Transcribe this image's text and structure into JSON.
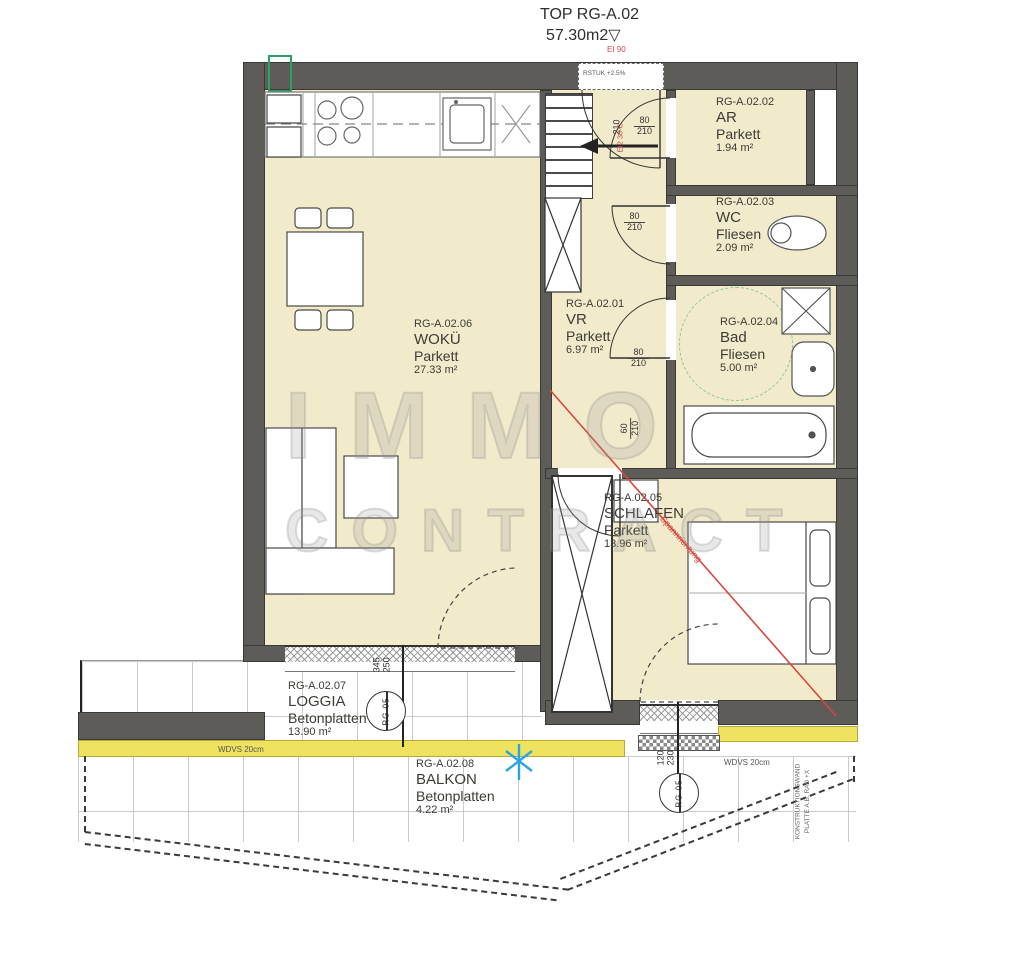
{
  "plan": {
    "title": "TOP RG-A.02",
    "area_total": "57.30m2",
    "level_symbol": "▽",
    "fire_note": "EI 90",
    "entrance_note": "RSTUK +2.5%",
    "entrance_fire_rating": "EI2 30-C",
    "span_note": "Spannrichtung",
    "watermark_line1": "IMMO",
    "watermark_line2": "CONTRACT"
  },
  "rooms": [
    {
      "id": "RG-A.02.01",
      "name": "VR",
      "floor": "Parkett",
      "area": "6.97 m²"
    },
    {
      "id": "RG-A.02.02",
      "name": "AR",
      "floor": "Parkett",
      "area": "1.94 m²"
    },
    {
      "id": "RG-A.02.03",
      "name": "WC",
      "floor": "Fliesen",
      "area": "2.09 m²"
    },
    {
      "id": "RG-A.02.04",
      "name": "Bad",
      "floor": "Fliesen",
      "area": "5.00 m²"
    },
    {
      "id": "RG-A.02.05",
      "name": "SCHLAFEN",
      "floor": "Parkett",
      "area": "13.96 m²"
    },
    {
      "id": "RG-A.02.06",
      "name": "WOKÜ",
      "floor": "Parkett",
      "area": "27.33 m²"
    },
    {
      "id": "RG-A.02.07",
      "name": "LOGGIA",
      "floor": "Betonplatten",
      "area": "13.90 m²"
    },
    {
      "id": "RG-A.02.08",
      "name": "BALKON",
      "floor": "Betonplatten",
      "area": "4.22 m²"
    }
  ],
  "dimensions": {
    "door_entrance_height": "210",
    "door_ar": {
      "w": "80",
      "h": "210"
    },
    "door_wc": {
      "w": "80",
      "h": "210"
    },
    "door_bad": {
      "w": "80",
      "h": "210"
    },
    "door_schlafen": {
      "w": "60",
      "h": "210"
    },
    "window_loggia": {
      "w": "345",
      "h": "250"
    },
    "door_balkon": {
      "w": "120",
      "h": "230"
    }
  },
  "labels": {
    "wdvs_left": "WDVS 20cm",
    "wdvs_right": "WDVS 20cm",
    "marker_loggia": "RG 05",
    "marker_balkon": "RG 05",
    "side_note_1": "KONSTRUKTIONSWAND",
    "side_note_2": "PLATTE A.B. RAD +X"
  },
  "colors": {
    "wall": "#5d5c58",
    "room_fill": "#f1ebcb",
    "insulation": "#efe25e",
    "accent_red": "#d9463e",
    "accent_blue": "#2ba3e8",
    "accent_green": "#2aa06a"
  }
}
